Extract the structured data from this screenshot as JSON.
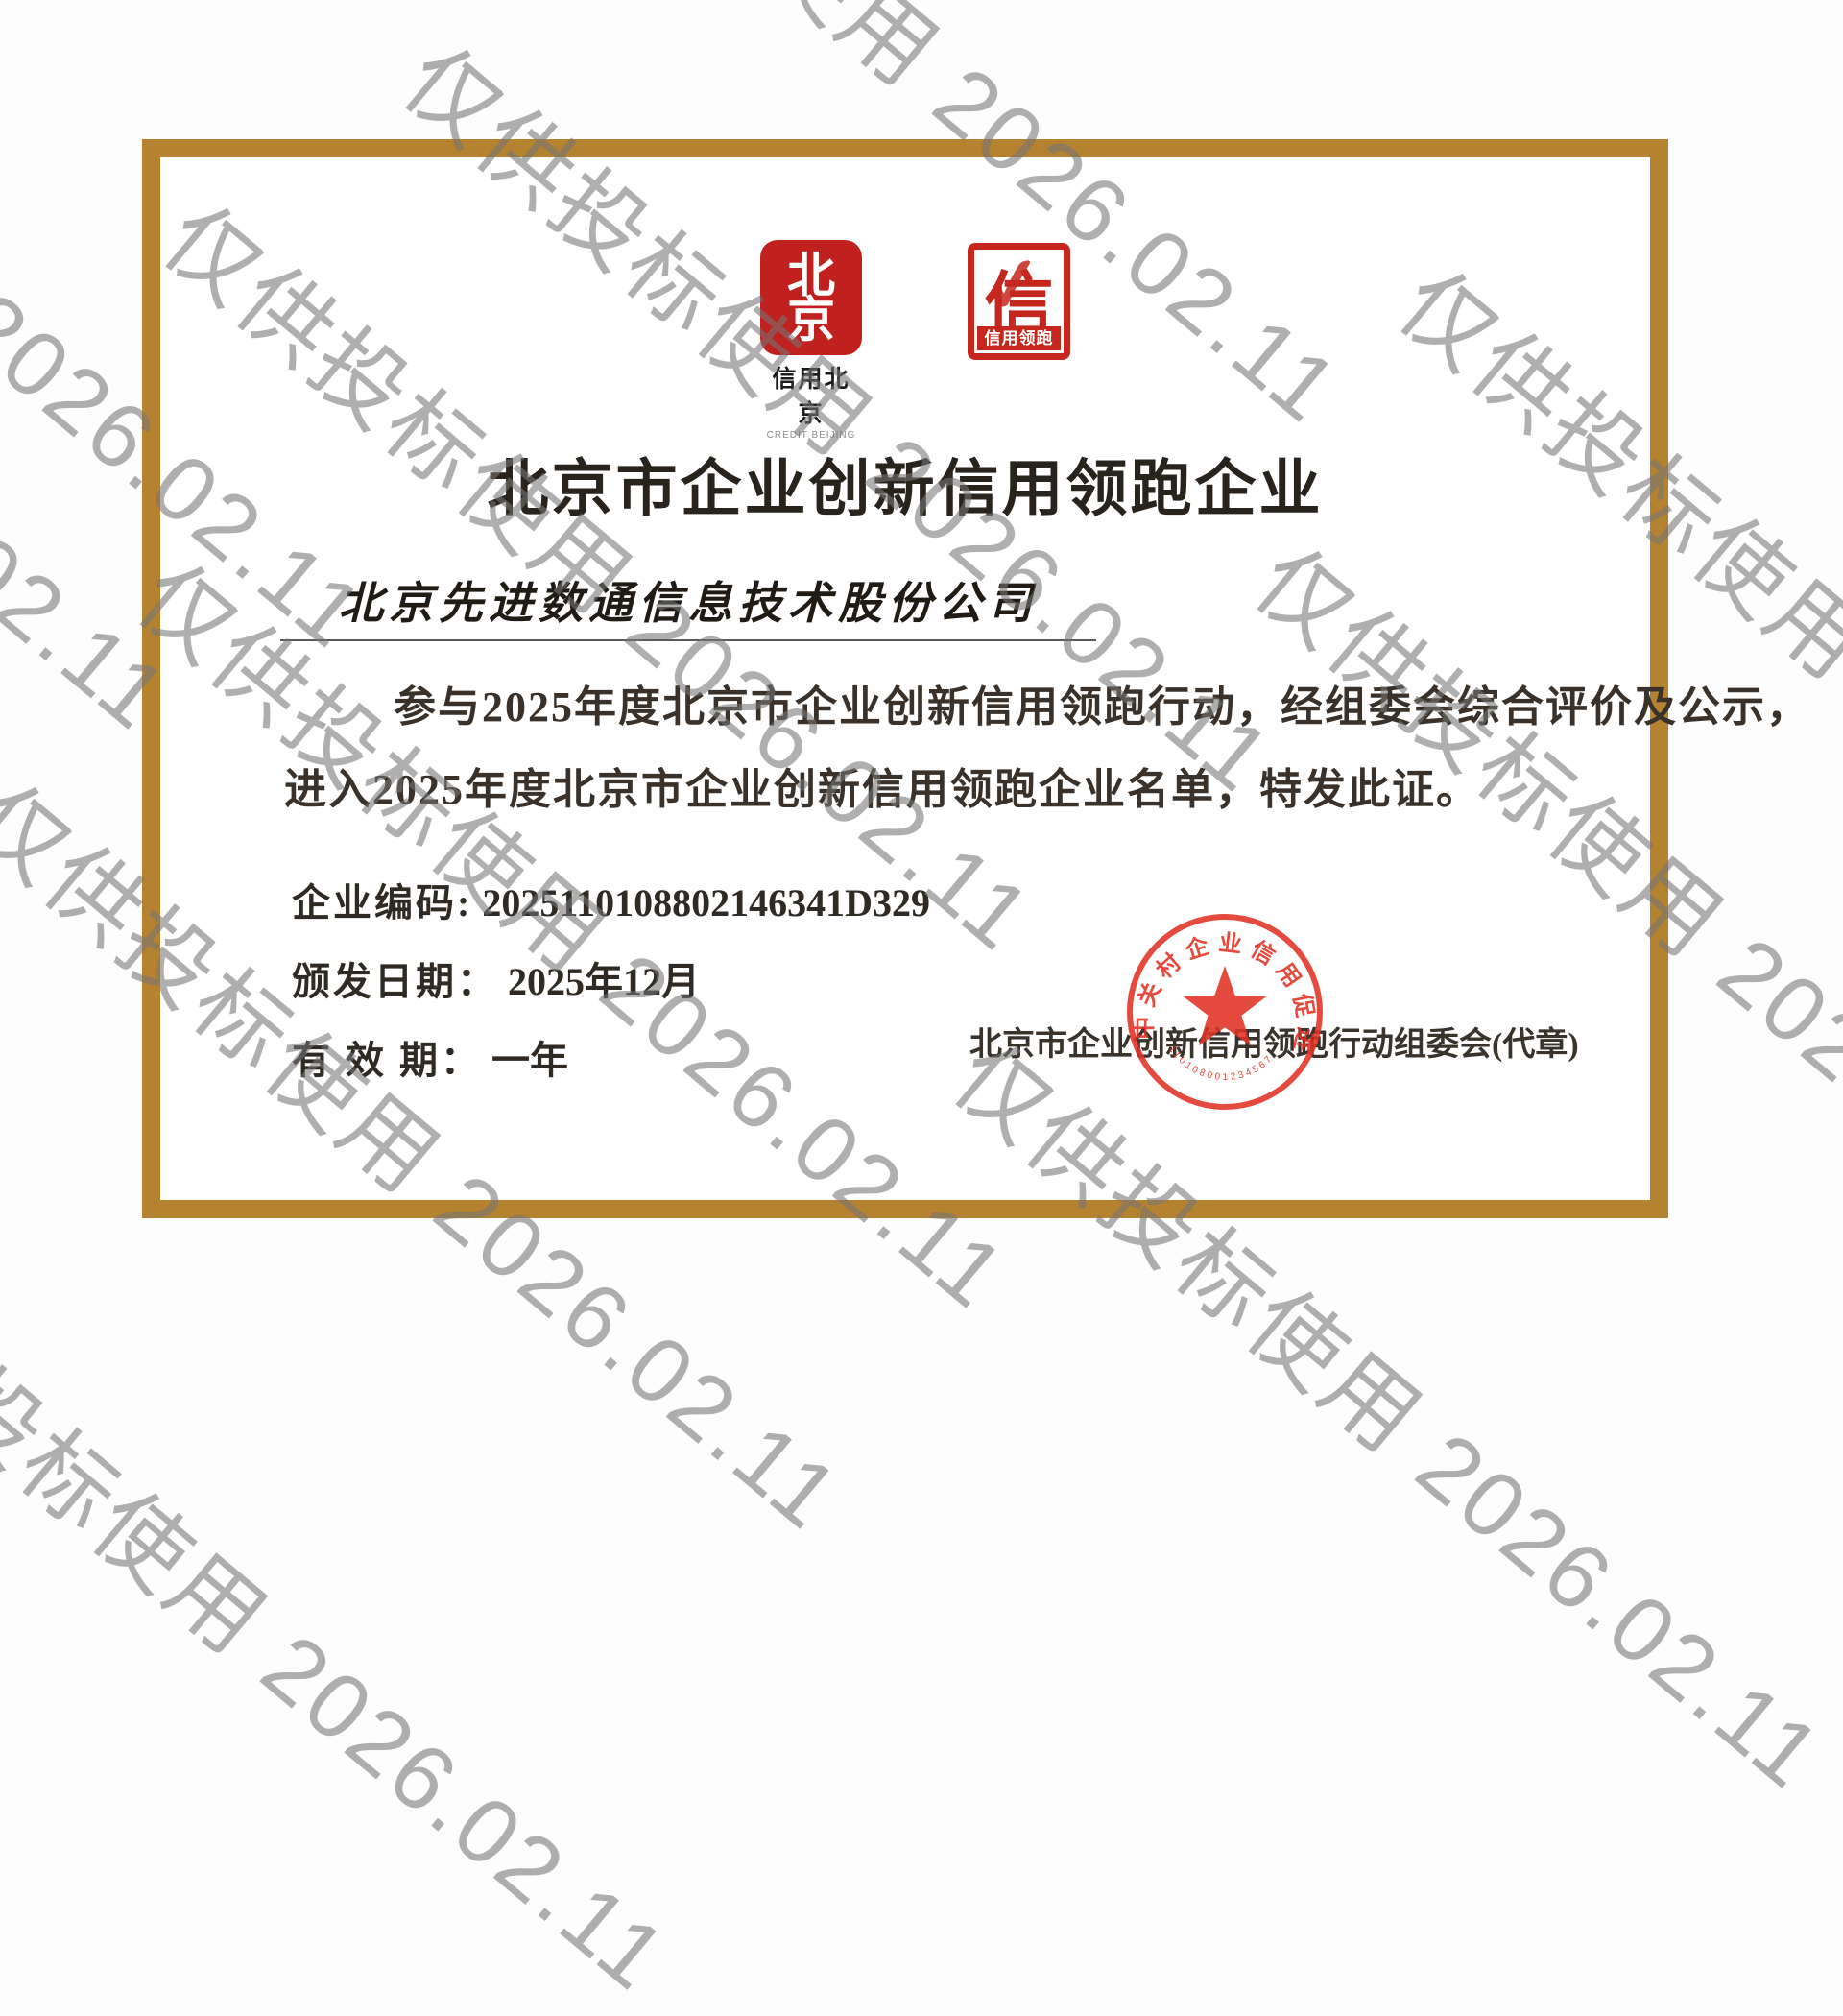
{
  "watermark": {
    "text": "仅供投标使用 2026.02.11"
  },
  "cert": {
    "border_color": "#b5822f",
    "logo1": {
      "glyph_top": "北",
      "glyph_bottom": "京",
      "label": "信用北京",
      "label_en": "CREDIT BEIJING"
    },
    "logo2": {
      "glyph": "信",
      "check": "✓",
      "band": "信用领跑"
    },
    "title": "北京市企业创新信用领跑企业",
    "company": "北京先进数通信息技术股份公司",
    "body1": "参与2025年度北京市企业创新信用领跑行动，经组委会综合评价及公示，",
    "body2": "进入2025年度北京市企业创新信用领跑企业名单，特发此证。",
    "fields": {
      "code_label": "企业编码:",
      "code_value": "2025110108802146341D329",
      "issue_label": "颁发日期：",
      "issue_value": "2025年12月",
      "valid_label": "有 效 期：",
      "valid_value": "一年"
    },
    "issuer": "北京市企业创新信用领跑行动组委会(代章)",
    "seal": {
      "arc": "中关村企业信用促进会",
      "serial": "110108001234567",
      "color": "#e13224"
    }
  }
}
